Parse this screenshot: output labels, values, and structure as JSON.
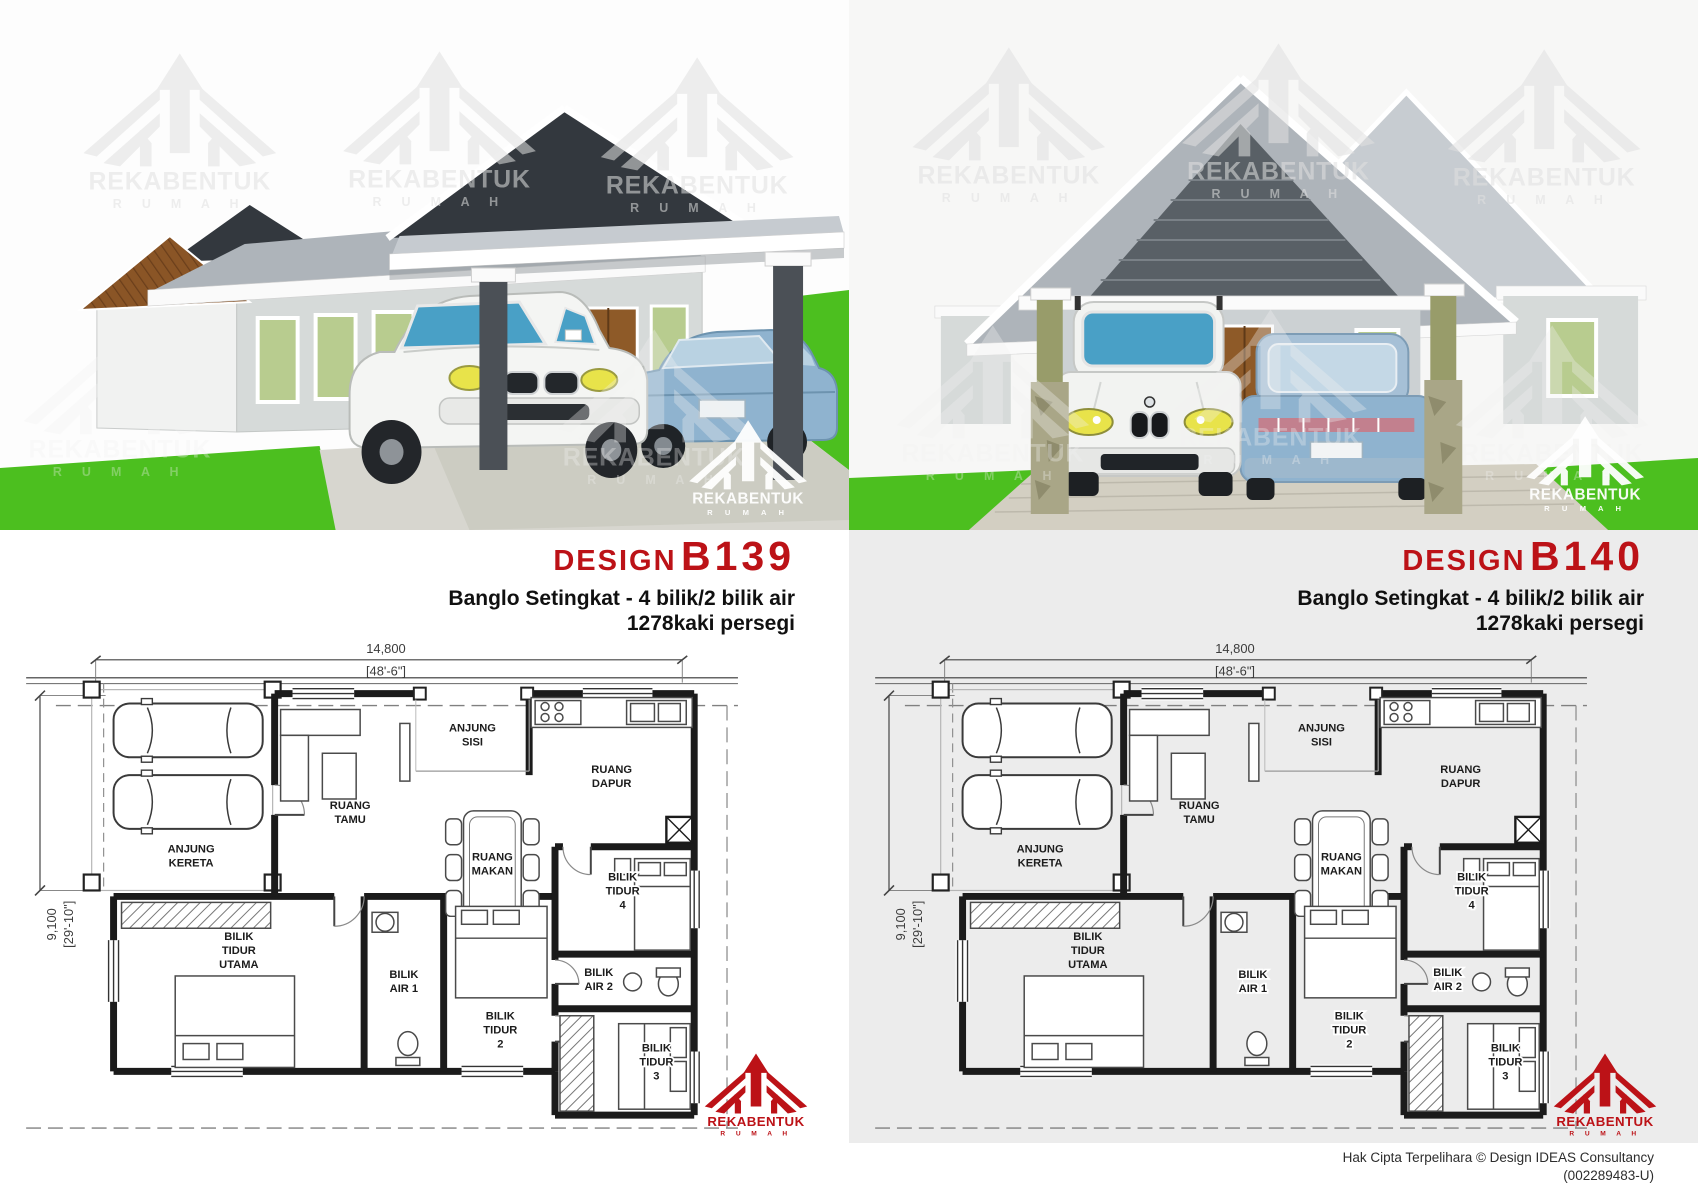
{
  "brand": {
    "name": "REKABENTUK",
    "sub": "R U M A H"
  },
  "palette": {
    "accent-red": "#bc1217",
    "panel-gray": "#ececec",
    "grass-green": "#4cbf1f",
    "window-green": "#b8cc8f",
    "door-brown": "#8e5a28",
    "roof-gray": "#aeb4ba",
    "roof-dark": "#33383e",
    "wall-gray": "#d6dad9",
    "car-blue": "#8fb3cf",
    "car-window-blue": "#49a0c6",
    "headlight-yellow": "#e8e34a",
    "stone-olive": "#989c6a",
    "pillar-dark": "#4b5056",
    "driveway-gray": "#d7d6cf",
    "watermark-gray": "#e1e1e1"
  },
  "panels": [
    {
      "design_label": "DESIGN",
      "code": "B139",
      "subtitle": "Banglo Setingkat - 4 bilik/2 bilik air",
      "area": "1278kaki persegi"
    },
    {
      "design_label": "DESIGN",
      "code": "B140",
      "subtitle": "Banglo Setingkat - 4 bilik/2 bilik air",
      "area": "1278kaki persegi"
    }
  ],
  "plan": {
    "dim_width": "14,800",
    "dim_width_ft": "[48'-6\"]",
    "dim_height": "9,100",
    "dim_height_ft": "[29'-10\"]",
    "rooms": {
      "anjung_kereta": [
        "ANJUNG",
        "KERETA"
      ],
      "ruang_tamu": [
        "RUANG",
        "TAMU"
      ],
      "anjung_sisi": [
        "ANJUNG",
        "SISI"
      ],
      "ruang_dapur": [
        "RUANG",
        "DAPUR"
      ],
      "ruang_makan": [
        "RUANG",
        "MAKAN"
      ],
      "bilik_tidur_4": [
        "BILIK",
        "TIDUR",
        "4"
      ],
      "bilik_air_2": [
        "BILIK",
        "AIR 2"
      ],
      "bilik_tidur_utama": [
        "BILIK",
        "TIDUR",
        "UTAMA"
      ],
      "bilik_air_1": [
        "BILIK",
        "AIR 1"
      ],
      "bilik_tidur_2": [
        "BILIK",
        "TIDUR",
        "2"
      ],
      "bilik_tidur_3": [
        "BILIK",
        "TIDUR",
        "3"
      ]
    }
  },
  "footer": {
    "line1": "Hak Cipta Terpelihara  © Design IDEAS Consultancy",
    "line2": "(002289483-U)"
  }
}
